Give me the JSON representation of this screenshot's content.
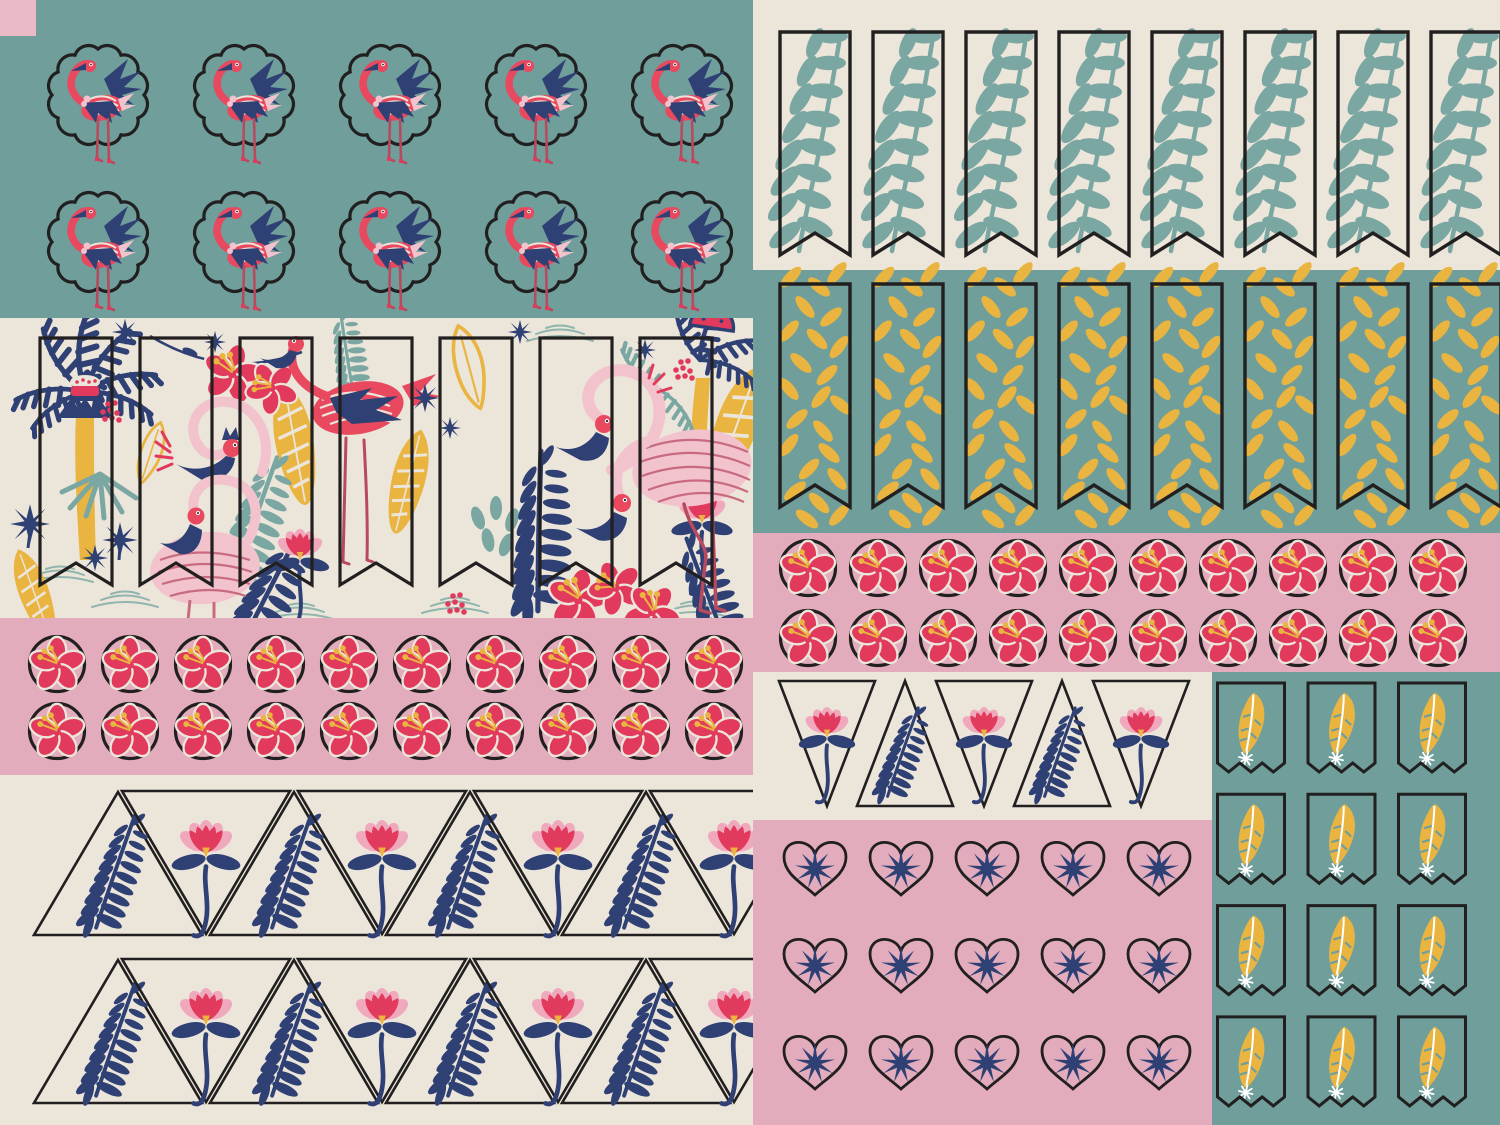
{
  "artwork": {
    "kind": "tropical-flamingo-sticker-sheet",
    "width_px": 1500,
    "height_px": 1125
  },
  "palette": {
    "teal": "#6f9e9b",
    "cream": "#ece5da",
    "pink": "#e2acbc",
    "pinklight": "#ecb9c6",
    "red": "#e23a5c",
    "flamingo": "#e8495f",
    "pale2": "#f2c3cd",
    "pinkpetal": "#f0a8bc",
    "navy": "#2f4074",
    "yellow": "#e9b440",
    "tealleaf": "#7ba7a3",
    "ink": "#211f1f",
    "leg": "#b84a5e",
    "rose": "#c96b80",
    "ripple": "#8fb5ad",
    "white": "#faf6ef"
  },
  "panels": [
    {
      "name": "teal-flamingo-panel",
      "rect": [
        0,
        0,
        753,
        318
      ],
      "color": "teal"
    },
    {
      "name": "pink-corner-patch",
      "rect": [
        0,
        0,
        36,
        36
      ],
      "color": "pinklight"
    },
    {
      "name": "cream-banner-panel",
      "rect": [
        753,
        0,
        747,
        270
      ],
      "color": "cream"
    },
    {
      "name": "teal-banner-panel",
      "rect": [
        753,
        270,
        747,
        263
      ],
      "color": "teal"
    },
    {
      "name": "pink-hibiscus-panel-right",
      "rect": [
        753,
        533,
        747,
        139
      ],
      "color": "pink"
    },
    {
      "name": "tropical-pattern-panel",
      "rect": [
        0,
        318,
        753,
        300
      ],
      "color": "cream"
    },
    {
      "name": "pink-hibiscus-panel-left",
      "rect": [
        0,
        618,
        753,
        157
      ],
      "color": "pink"
    },
    {
      "name": "cream-triangle-panel",
      "rect": [
        0,
        775,
        753,
        350
      ],
      "color": "cream"
    },
    {
      "name": "cream-triangle-strip",
      "rect": [
        753,
        672,
        459,
        148
      ],
      "color": "cream"
    },
    {
      "name": "pink-heart-panel",
      "rect": [
        753,
        820,
        459,
        305
      ],
      "color": "pink"
    },
    {
      "name": "teal-feather-panel",
      "rect": [
        1212,
        672,
        288,
        453
      ],
      "color": "teal"
    }
  ],
  "sticker_sets": [
    {
      "name": "flamingo-scallop-sticker",
      "symbol": "sym-flamingo-scallop",
      "panel": "teal-flamingo-panel",
      "start": [
        98,
        95
      ],
      "pitch": [
        146,
        147
      ],
      "cols": 5,
      "rows": 2
    },
    {
      "name": "teal-leaf-banner-sticker",
      "symbol": "sym-leaf-banner",
      "panel": "cream-banner-panel",
      "start": [
        815,
        143
      ],
      "pitch": [
        93,
        0
      ],
      "cols": 8,
      "rows": 1
    },
    {
      "name": "yellow-seed-banner-sticker",
      "symbol": "sym-seed-banner",
      "panel": "teal-banner-panel",
      "start": [
        815,
        395
      ],
      "pitch": [
        93,
        0
      ],
      "cols": 8,
      "rows": 1
    },
    {
      "name": "hibiscus-circle-sticker",
      "symbol": "sym-hibiscus-circle",
      "panel": "pink-hibiscus-panel-right",
      "start": [
        808,
        568
      ],
      "pitch": [
        70,
        70
      ],
      "cols": 10,
      "rows": 2
    },
    {
      "name": "hibiscus-circle-sticker",
      "symbol": "sym-hibiscus-circle",
      "panel": "pink-hibiscus-panel-left",
      "start": [
        57,
        664
      ],
      "pitch": [
        73,
        67
      ],
      "cols": 10,
      "rows": 2
    },
    {
      "name": "fern-triangle-sticker",
      "symbol": "sym-tri-up",
      "panel": "cream-triangle-panel",
      "start": [
        118,
        863
      ],
      "pitch": [
        176,
        168
      ],
      "cols": 4,
      "rows": 2,
      "clip": "clip-bottom-left"
    },
    {
      "name": "lotus-triangle-sticker",
      "symbol": "sym-tri-down",
      "panel": "cream-triangle-panel",
      "start": [
        206,
        863
      ],
      "pitch": [
        176,
        168
      ],
      "cols": 4,
      "rows": 2,
      "clip": "clip-bottom-left"
    },
    {
      "name": "lotus-triangle-sticker-small",
      "symbol": "sym-tri-down-sm",
      "panel": "cream-triangle-strip",
      "start": [
        827,
        743
      ],
      "pitch": [
        157,
        0
      ],
      "cols": 3,
      "rows": 1
    },
    {
      "name": "fern-triangle-sticker-small",
      "symbol": "sym-tri-up-sm",
      "panel": "cream-triangle-strip",
      "start": [
        905,
        743
      ],
      "pitch": [
        157,
        0
      ],
      "cols": 2,
      "rows": 1
    },
    {
      "name": "heart-palm-sticker",
      "symbol": "sym-heart",
      "panel": "pink-heart-panel",
      "start": [
        815,
        866
      ],
      "pitch": [
        86,
        97
      ],
      "cols": 5,
      "rows": 3
    },
    {
      "name": "feather-flag-sticker",
      "symbol": "sym-feather-flag",
      "panel": "teal-feather-panel",
      "start": [
        1251,
        727
      ],
      "pitch": [
        90.5,
        111.3
      ],
      "cols": 3,
      "rows": 4
    }
  ],
  "tropical_banner_flags": {
    "count": 7,
    "start_x": 40,
    "pitch_x": 100,
    "top_y": 338,
    "bottom_y": 585,
    "width": 72
  }
}
